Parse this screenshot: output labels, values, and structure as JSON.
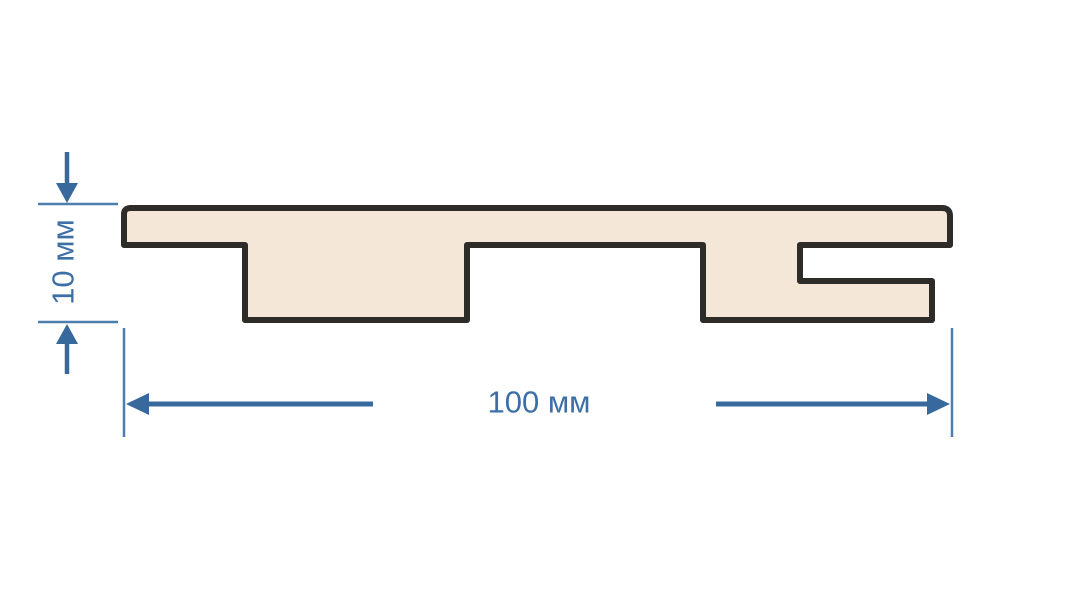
{
  "diagram": {
    "subject": "slat-panel-profile-cross-section",
    "background": "#ffffff",
    "profile": {
      "fill": "#f4e7d8",
      "outline": "#2e2c29"
    },
    "dimensions": {
      "height_label": "10 мм",
      "width_label": "100 мм",
      "line_color": "#38699c",
      "extension_line_color": "#4d7fae",
      "text_color": "#3d6fa6"
    }
  }
}
